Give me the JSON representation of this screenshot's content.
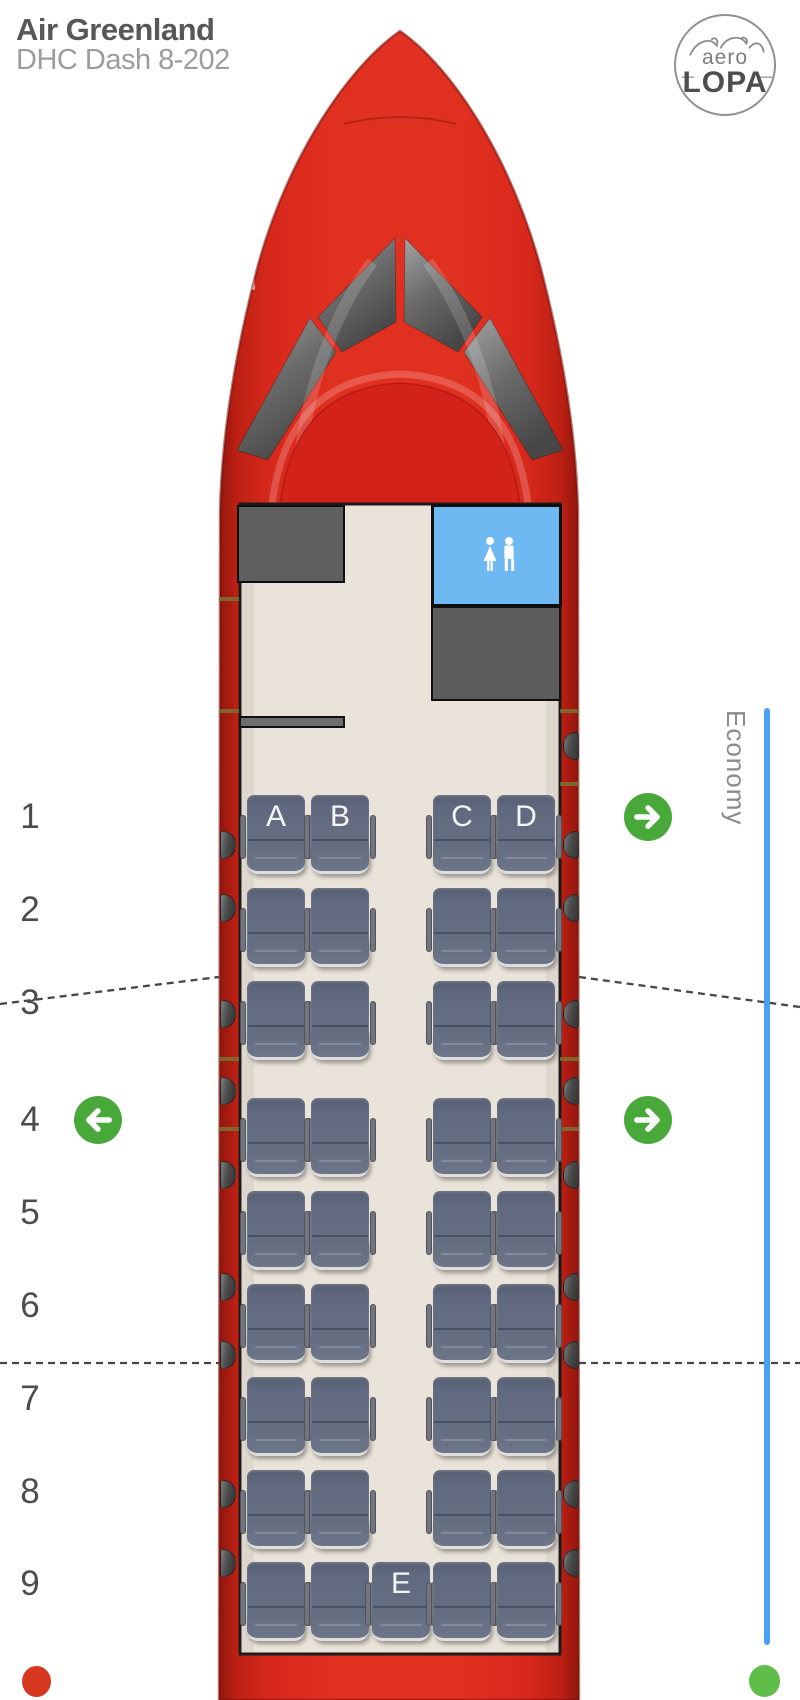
{
  "header": {
    "airline": "Air Greenland",
    "aircraft": "DHC Dash 8-202"
  },
  "logo": {
    "top": "aero",
    "bottom": "LOPA"
  },
  "cabin": {
    "class_label": "Economy",
    "lavatory": "lavatory",
    "monuments": [
      "galley-front-left",
      "lavatory-front-right",
      "galley-aft-of-lavatory",
      "airstair-door-front-left"
    ]
  },
  "rows": [
    {
      "number": "1",
      "exits": [
        "right"
      ],
      "seats": [
        {
          "pos": "A",
          "letter": "A"
        },
        {
          "pos": "B",
          "letter": "B"
        },
        {
          "pos": "C",
          "letter": "C"
        },
        {
          "pos": "D",
          "letter": "D"
        }
      ]
    },
    {
      "number": "2",
      "exits": [],
      "seats": [
        {
          "pos": "A",
          "letter": ""
        },
        {
          "pos": "B",
          "letter": ""
        },
        {
          "pos": "C",
          "letter": ""
        },
        {
          "pos": "D",
          "letter": ""
        }
      ]
    },
    {
      "number": "3",
      "exits": [],
      "seats": [
        {
          "pos": "A",
          "letter": ""
        },
        {
          "pos": "B",
          "letter": ""
        },
        {
          "pos": "C",
          "letter": ""
        },
        {
          "pos": "D",
          "letter": ""
        }
      ]
    },
    {
      "number": "4",
      "exits": [
        "left",
        "right"
      ],
      "seats": [
        {
          "pos": "A",
          "letter": ""
        },
        {
          "pos": "B",
          "letter": ""
        },
        {
          "pos": "C",
          "letter": ""
        },
        {
          "pos": "D",
          "letter": ""
        }
      ]
    },
    {
      "number": "5",
      "exits": [],
      "seats": [
        {
          "pos": "A",
          "letter": ""
        },
        {
          "pos": "B",
          "letter": ""
        },
        {
          "pos": "C",
          "letter": ""
        },
        {
          "pos": "D",
          "letter": ""
        }
      ]
    },
    {
      "number": "6",
      "exits": [],
      "seats": [
        {
          "pos": "A",
          "letter": ""
        },
        {
          "pos": "B",
          "letter": ""
        },
        {
          "pos": "C",
          "letter": ""
        },
        {
          "pos": "D",
          "letter": ""
        }
      ]
    },
    {
      "number": "7",
      "exits": [],
      "seats": [
        {
          "pos": "A",
          "letter": ""
        },
        {
          "pos": "B",
          "letter": ""
        },
        {
          "pos": "C",
          "letter": ""
        },
        {
          "pos": "D",
          "letter": ""
        }
      ]
    },
    {
      "number": "8",
      "exits": [],
      "seats": [
        {
          "pos": "A",
          "letter": ""
        },
        {
          "pos": "B",
          "letter": ""
        },
        {
          "pos": "C",
          "letter": ""
        },
        {
          "pos": "D",
          "letter": ""
        }
      ]
    },
    {
      "number": "9",
      "exits": [],
      "seats": [
        {
          "pos": "A",
          "letter": ""
        },
        {
          "pos": "B",
          "letter": ""
        },
        {
          "pos": "E",
          "letter": "E"
        },
        {
          "pos": "C",
          "letter": ""
        },
        {
          "pos": "D",
          "letter": ""
        }
      ]
    }
  ],
  "colors": {
    "fuselage_red": "#d7281c",
    "fuselage_red_dark": "#8f160d",
    "interior_beige": "#eae3d9",
    "seat_gray_blue": "#666e82",
    "seat_cushion": "#6d7589",
    "armrest": "#71757d",
    "galley_gray": "#5f5f5f",
    "lavatory_blue": "#6fb9f3",
    "exit_green": "#48a93a",
    "economy_blue": "#4aa1f1",
    "dot_red": "#d8371f",
    "dot_green": "#5fbe49",
    "window_dark": "#333333",
    "door_mark_olive": "#7b7233",
    "title_dark": "#575757",
    "title_gray": "#9c9c9c",
    "row_number_gray": "#4c4c4c",
    "label_gray": "#8a8a8a"
  }
}
